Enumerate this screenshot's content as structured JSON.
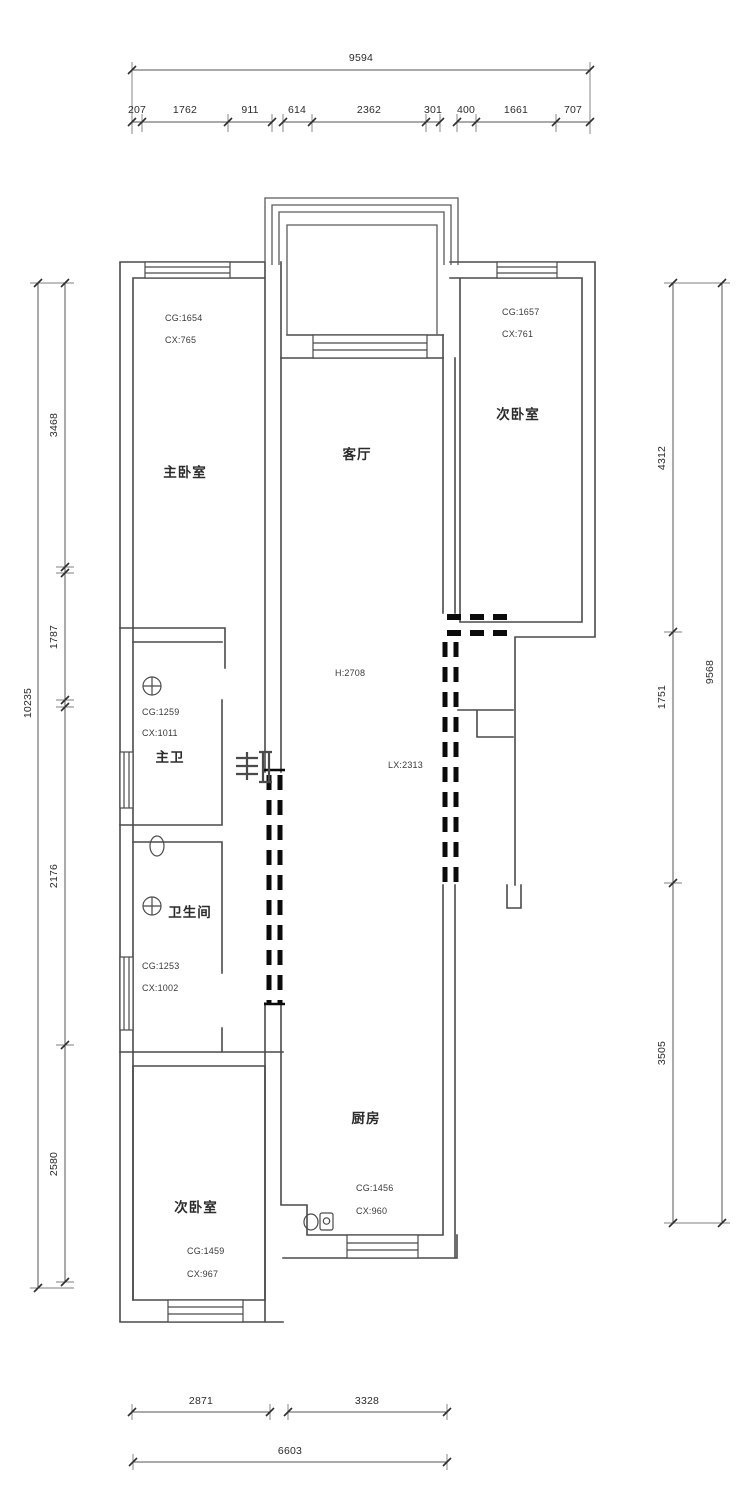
{
  "drawing": {
    "type": "apartment-floor-plan"
  },
  "dimensions": {
    "top": {
      "total": "9594",
      "segments": [
        "207",
        "1762",
        "911",
        "614",
        "2362",
        "301",
        "400",
        "1661",
        "707"
      ]
    },
    "left": {
      "total": "10235",
      "segments": [
        "3468",
        "1787",
        "2176",
        "2580"
      ]
    },
    "right": {
      "total": "9568",
      "segments": [
        "4312",
        "1751",
        "3505"
      ]
    },
    "bottom": {
      "total": "6603",
      "segments": [
        "2871",
        "3328"
      ]
    }
  },
  "rooms": {
    "master_bedroom": {
      "name": "主卧室",
      "cg": "CG:1654",
      "cx": "CX:765"
    },
    "bedroom_ne": {
      "name": "次卧室",
      "cg": "CG:1657",
      "cx": "CX:761"
    },
    "living": {
      "name": "客厅",
      "height": "H:2708",
      "lx": "LX:2313"
    },
    "master_bath": {
      "name": "主卫",
      "cg": "CG:1259",
      "cx": "CX:1011"
    },
    "bathroom": {
      "name": "卫生间",
      "cg": "CG:1253",
      "cx": "CX:1002"
    },
    "bedroom_sw": {
      "name": "次卧室",
      "cg": "CG:1459",
      "cx": "CX:967"
    },
    "kitchen": {
      "name": "厨房",
      "cg": "CG:1456",
      "cx": "CX:960"
    }
  }
}
